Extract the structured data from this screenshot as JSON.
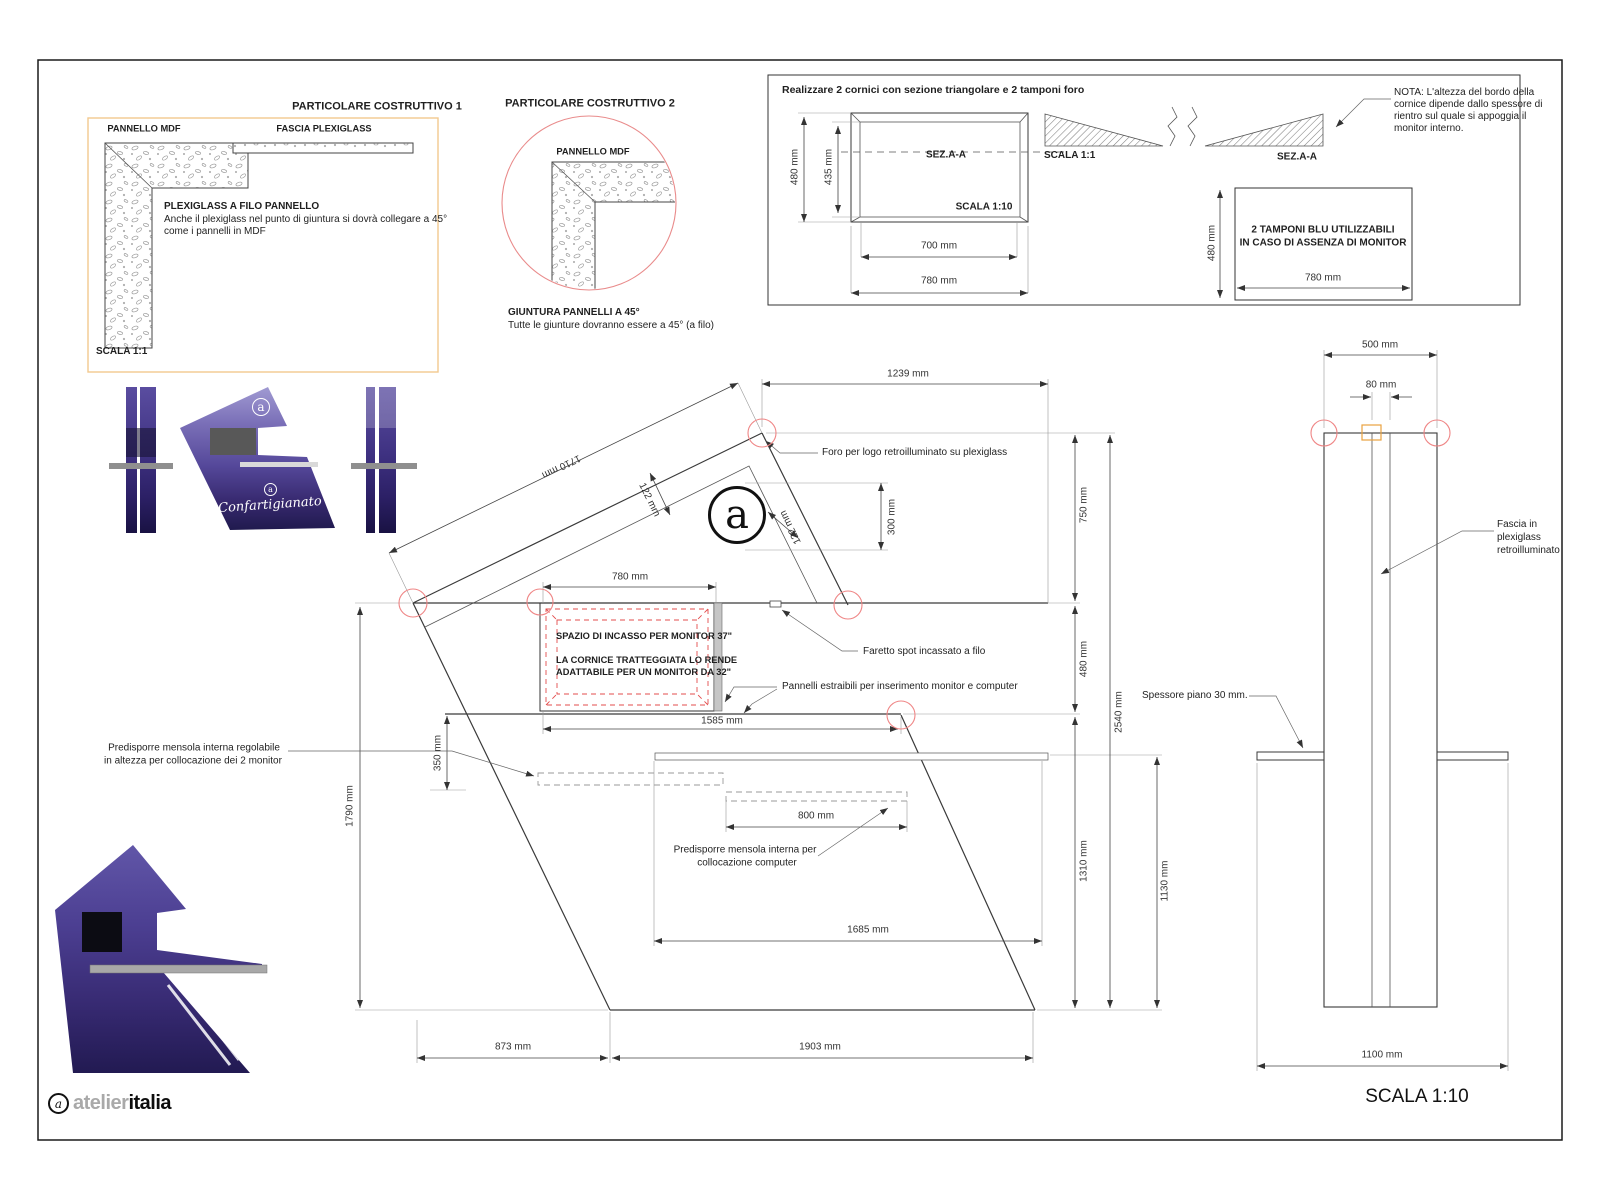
{
  "detail1": {
    "title": "PARTICOLARE COSTRUTTIVO 1",
    "mdf_label": "PANNELLO MDF",
    "fascia_label": "FASCIA PLEXIGLASS",
    "note_title": "PLEXIGLASS A FILO PANNELLO",
    "note_line1": "Anche il plexiglass nel punto di giuntura si dovrà collegare a 45°",
    "note_line2": "come i pannelli in MDF",
    "scale": "SCALA 1:1"
  },
  "detail2": {
    "title": "PARTICOLARE COSTRUTTIVO 2",
    "mdf_label": "PANNELLO MDF",
    "note_title": "GIUNTURA PANNELLI A 45°",
    "note_line1": "Tutte le giunture dovranno essere a 45° (a filo)"
  },
  "cornici": {
    "title": "Realizzare 2 cornici con sezione triangolare e 2 tamponi foro",
    "dim_height": "480 mm",
    "dim_inner_height": "435 mm",
    "section_label": "SEZ.A-A",
    "scale_front": "SCALA 1:10",
    "dim_inner_width": "700 mm",
    "dim_width": "780 mm",
    "scale_section": "SCALA 1:1",
    "section_label2": "SEZ.A-A",
    "nota": [
      "NOTA: L'altezza del bordo della",
      "cornice dipende dallo spessore di",
      "rientro sul quale si appoggia il",
      "monitor interno."
    ],
    "tamponi_line1": "2 TAMPONI BLU UTILIZZABILI",
    "tamponi_line2": "IN CASO DI ASSENZA DI MONITOR",
    "tamponi_dim_height": "480 mm",
    "tamponi_dim_width": "780 mm"
  },
  "plan": {
    "dims": {
      "w_top": "1239 mm",
      "edge": "1710 mm",
      "band_a": "122 mm",
      "band_b": "122 mm",
      "logo_h": "300 mm",
      "monitor_w": "780 mm",
      "shelf_span": "1585 mm",
      "mensola_offset": "350 mm",
      "left_h": "1790 mm",
      "top_h": "750 mm",
      "mid_h": "480 mm",
      "total_h": "2540 mm",
      "bottom_h": "1310 mm",
      "base_h": "1130 mm",
      "mensola_w": "800 mm",
      "inner_w": "1685 mm",
      "base_left": "873 mm",
      "base_right": "1903 mm"
    },
    "notes": {
      "foro": "Foro per logo retroilluminato su plexiglass",
      "faretto": "Faretto spot incassato a filo",
      "pannelli": "Pannelli estraibili per inserimento monitor e computer",
      "monitor_line1": "SPAZIO DI INCASSO PER MONITOR 37\"",
      "monitor_line2": "LA CORNICE TRATTEGGIATA LO RENDE",
      "monitor_line3": "ADATTABILE PER UN MONITOR DA 32\"",
      "mensola_monitor_line1": "Predisporre mensola interna regolabile",
      "mensola_monitor_line2": "in altezza per collocazione dei 2 monitor",
      "mensola_computer_line1": "Predisporre mensola interna per",
      "mensola_computer_line2": "collocazione computer"
    }
  },
  "side": {
    "dims": {
      "width": "500 mm",
      "fascia": "80 mm",
      "base": "1100 mm"
    },
    "notes": {
      "fascia_line1": "Fascia in",
      "fascia_line2": "plexiglass",
      "fascia_line3": "retroilluminato",
      "spessore": "Spessore piano 30 mm."
    }
  },
  "render": {
    "brand_script": "Confartigianato"
  },
  "logo": {
    "a": "a",
    "atelier": "atelier",
    "italia": "italia"
  },
  "footer": {
    "scale": "SCALA 1:10"
  }
}
